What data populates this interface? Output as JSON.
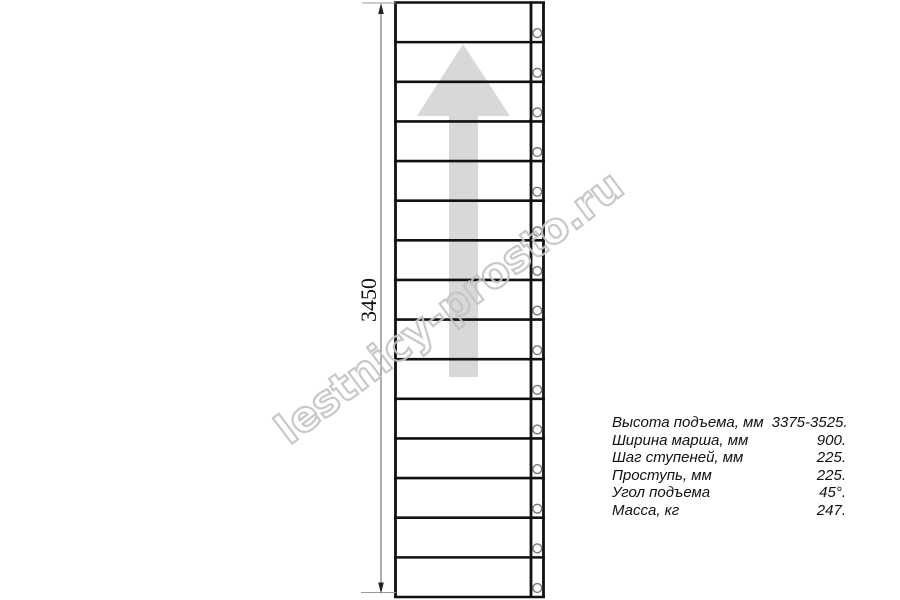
{
  "watermark": {
    "text": "lestnicy-prosto.ru"
  },
  "dimension": {
    "value": "3450"
  },
  "diagram": {
    "type": "staircase-plan-top-view",
    "steps": 15,
    "arrow_direction": "up"
  },
  "specs": {
    "rows": [
      {
        "label": "Высота подъема, мм",
        "value": "3375-3525."
      },
      {
        "label": "Ширина марша, мм",
        "value": "900."
      },
      {
        "label": "Шаг ступеней, мм",
        "value": "225."
      },
      {
        "label": "Проступь, мм",
        "value": "225."
      },
      {
        "label": "Угол подъема",
        "value": "45°."
      },
      {
        "label": "Масса, кг",
        "value": "247."
      }
    ]
  },
  "colors": {
    "line": "#111111",
    "arrow": "#d8d8d8",
    "watermark": "#c3c3c3",
    "dimension": "#777777"
  }
}
